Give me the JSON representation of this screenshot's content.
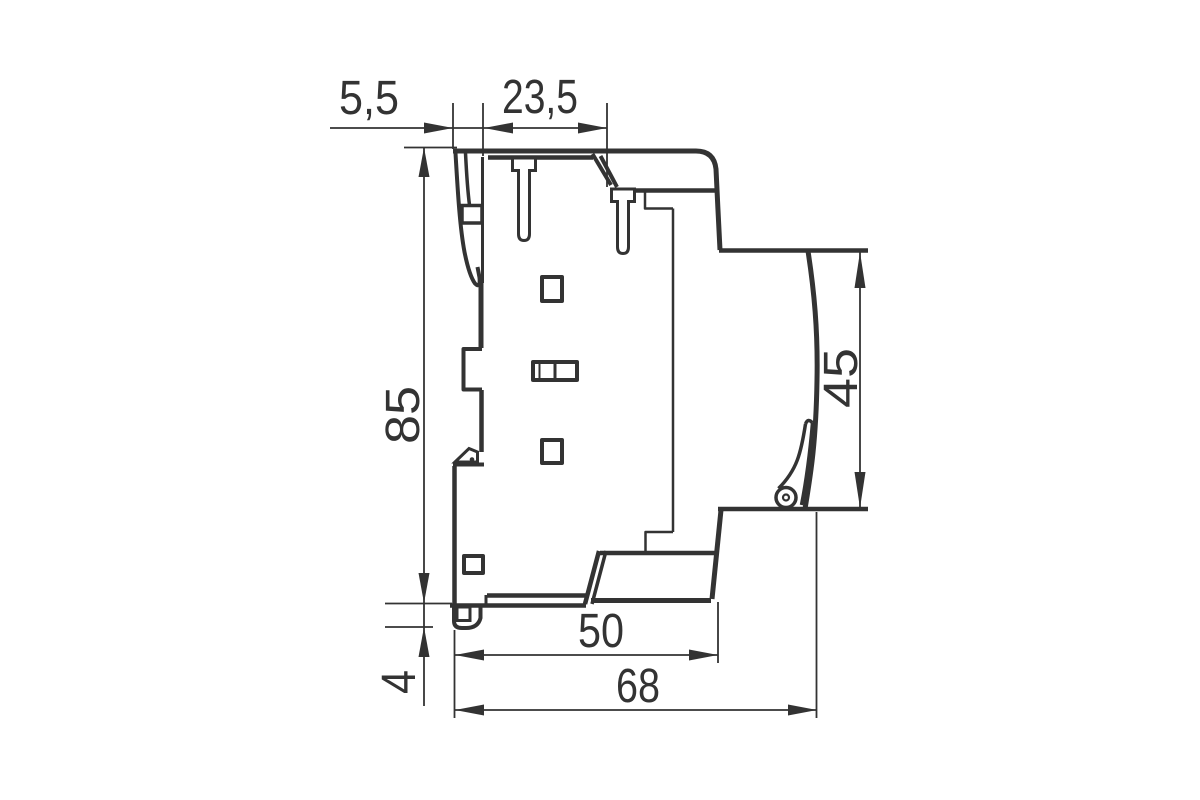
{
  "drawing": {
    "title": "Side view dimension drawing of DIN-rail modular device",
    "line_color": "#333333",
    "background_color": "#ffffff",
    "dimensions": {
      "rear_clip_depth": "5,5",
      "top_front_depth": "23,5",
      "overall_height": "85",
      "front_face_height": "45",
      "rail_foot_height": "4",
      "lower_body_depth": "50",
      "overall_depth": "68"
    }
  }
}
